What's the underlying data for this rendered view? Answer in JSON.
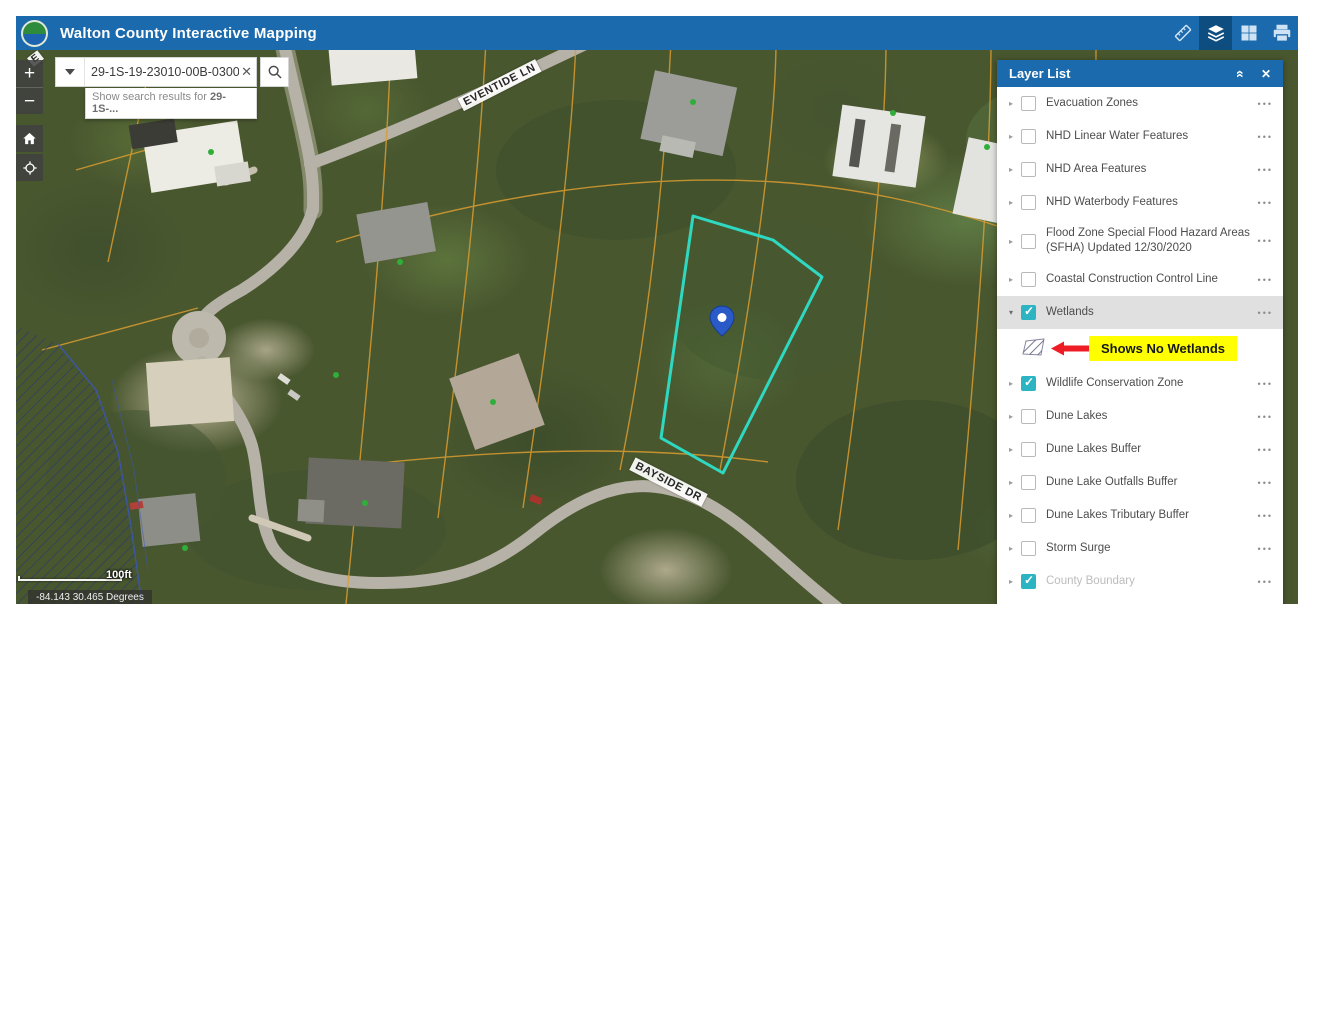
{
  "app": {
    "title": "Walton County Interactive Mapping"
  },
  "header_toolbar": {
    "icons": [
      {
        "name": "measure-icon",
        "active": false
      },
      {
        "name": "layers-icon",
        "active": true
      },
      {
        "name": "basemap-gallery-icon",
        "active": false
      },
      {
        "name": "print-icon",
        "active": false
      }
    ]
  },
  "search": {
    "value": "29-1S-19-23010-00B-0300",
    "clear_glyph": "✕",
    "suggestion_prefix": "Show search results for ",
    "suggestion_term": "29-1S-..."
  },
  "map_controls": {
    "zoom_in": "+",
    "zoom_out": "−"
  },
  "map": {
    "street_labels": [
      {
        "text": "EVENTIDE LN"
      },
      {
        "text": "BAYSIDE DR"
      },
      {
        "text": "E"
      }
    ],
    "scale_label": "100ft",
    "coordinates": "-84.143 30.465 Degrees"
  },
  "layer_list": {
    "title": "Layer List",
    "items": [
      {
        "label": "Evacuation Zones",
        "checked": false
      },
      {
        "label": "NHD Linear Water Features",
        "checked": false
      },
      {
        "label": "NHD Area Features",
        "checked": false
      },
      {
        "label": "NHD Waterbody Features",
        "checked": false
      },
      {
        "label": "Flood Zone Special Flood Hazard Areas (SFHA) Updated 12/30/2020",
        "checked": false,
        "tall": true
      },
      {
        "label": "Coastal Construction Control Line",
        "checked": false
      },
      {
        "label": "Wetlands",
        "checked": true,
        "selected": true,
        "expanded": true,
        "legend": true
      },
      {
        "label": "Wildlife Conservation Zone",
        "checked": true
      },
      {
        "label": "Dune Lakes",
        "checked": false
      },
      {
        "label": "Dune Lakes Buffer",
        "checked": false
      },
      {
        "label": "Dune Lake Outfalls Buffer",
        "checked": false
      },
      {
        "label": "Dune Lakes Tributary Buffer",
        "checked": false
      },
      {
        "label": "Storm Surge",
        "checked": false
      },
      {
        "label": "County Boundary",
        "checked": true,
        "grayed": true
      },
      {
        "label": "",
        "checked": true,
        "partial": true
      }
    ],
    "annotation": {
      "text": "Shows No Wetlands",
      "bg": "#ffff00",
      "arrow_color": "#ee1c25"
    }
  },
  "colors": {
    "header_bg": "#1b6aad",
    "checked_checkbox": "#2cb4c2",
    "parcel_outline": "#2fd8c0",
    "parcel_lines": "#d99c30",
    "annotation_bg": "#ffff00",
    "annotation_arrow": "#ee1c25"
  }
}
